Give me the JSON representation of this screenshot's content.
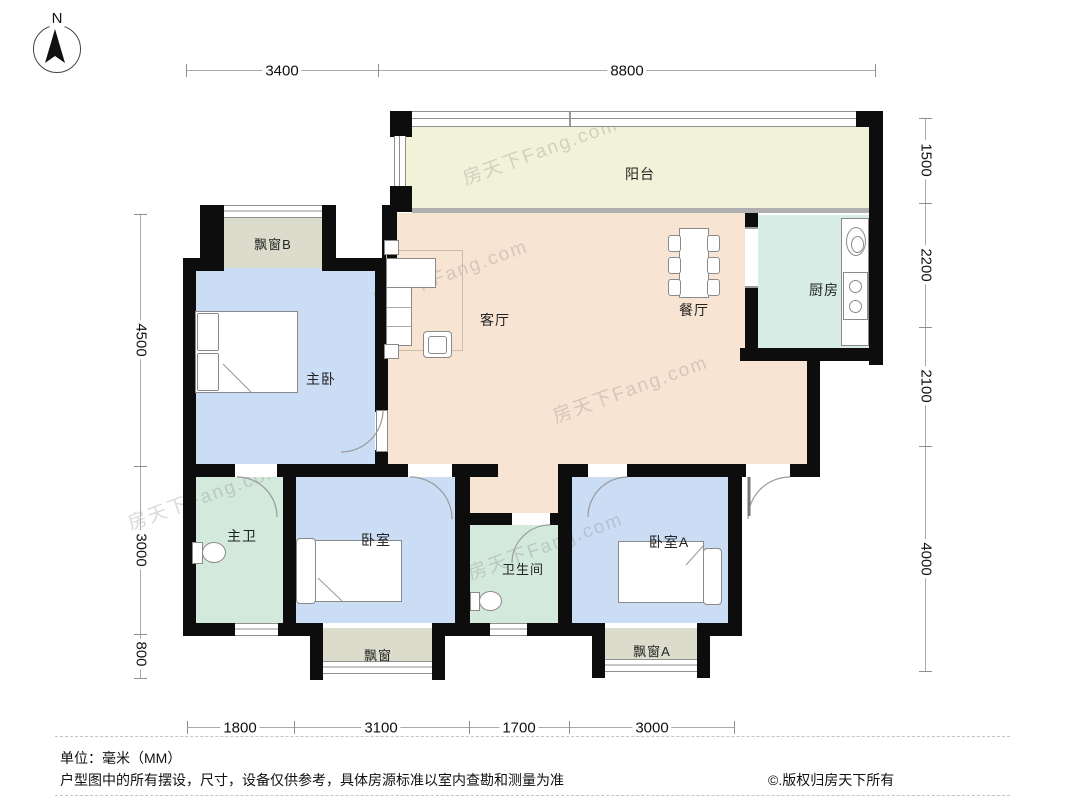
{
  "compass": {
    "north_label": "N"
  },
  "rooms": {
    "balcony": {
      "label": "阳台"
    },
    "bay_window_b": {
      "label": "飘窗B"
    },
    "master_bedroom": {
      "label": "主卧"
    },
    "living_room": {
      "label": "客厅"
    },
    "dining_room": {
      "label": "餐厅"
    },
    "kitchen": {
      "label": "厨房"
    },
    "master_bath": {
      "label": "主卫"
    },
    "bedroom": {
      "label": "卧室"
    },
    "bathroom": {
      "label": "卫生间"
    },
    "bedroom_a": {
      "label": "卧室A"
    },
    "bay_window": {
      "label": "飘窗"
    },
    "bay_window_a": {
      "label": "飘窗A"
    }
  },
  "dimensions": {
    "top": [
      "3400",
      "8800"
    ],
    "bottom": [
      "1800",
      "3100",
      "1700",
      "3000"
    ],
    "left": [
      "4500",
      "3000",
      "800"
    ],
    "right": [
      "1500",
      "2200",
      "2100",
      "4000"
    ]
  },
  "footer": {
    "unit": "单位：毫米（MM）",
    "disclaimer": "户型图中的所有摆设，尺寸，设备仅供参考，具体房源标准以室内查勘和测量为准",
    "copyright": "©.版权归房天下所有"
  },
  "watermark": "房天下Fang.com",
  "colors": {
    "living_dining": "#f7e4d2",
    "balcony": "#f2f2d9",
    "kitchen": "#d6ece5",
    "bath": "#d2e9dc",
    "bedroom": "#cbdcf5",
    "bay_window": "#dcdccc",
    "wall": "#0d0d0d"
  }
}
